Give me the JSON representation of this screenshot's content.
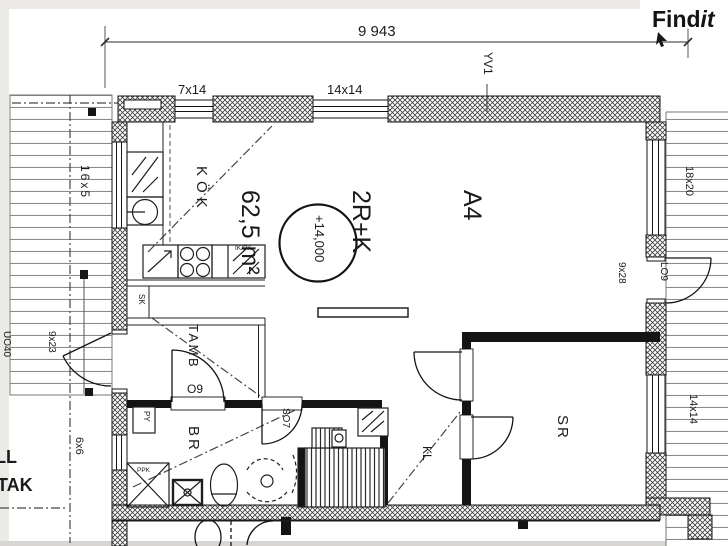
{
  "logo": {
    "bold": "Find",
    "italic": "it"
  },
  "title_block": {
    "unit": "A4",
    "type": "2R+K",
    "area": "62,5 m²"
  },
  "rooms": {
    "kitchen": "KÖK",
    "hall": "TAMB",
    "bathroom": "BR",
    "closet": "KL",
    "bedroom": "SR"
  },
  "levels": {
    "floor_level": "+14,000"
  },
  "dimensions": {
    "overall_width": "9 943",
    "balcony": "16x5",
    "small_window": "6x6"
  },
  "openings": {
    "window_top_1": "7x14",
    "window_top_2": "14x14",
    "window_right_1": "18x20",
    "window_right_2": "14x14",
    "door_left_size": "9x23",
    "door_left_code": "UO40",
    "door_right_code": "LO9",
    "door_right_size": "9x28",
    "door_hall": "O9",
    "door_shower": "SO7",
    "wall_tag": "YV1"
  },
  "annotations": {
    "py": "PY",
    "ppk": "PPK",
    "ikpk": "IK/PK",
    "sk": "SK",
    "ll": "LL",
    "tak": "TAK"
  },
  "colors": {
    "line": "#1b1b1b",
    "paper": "#ffffff",
    "margin": "#ebeae7"
  }
}
